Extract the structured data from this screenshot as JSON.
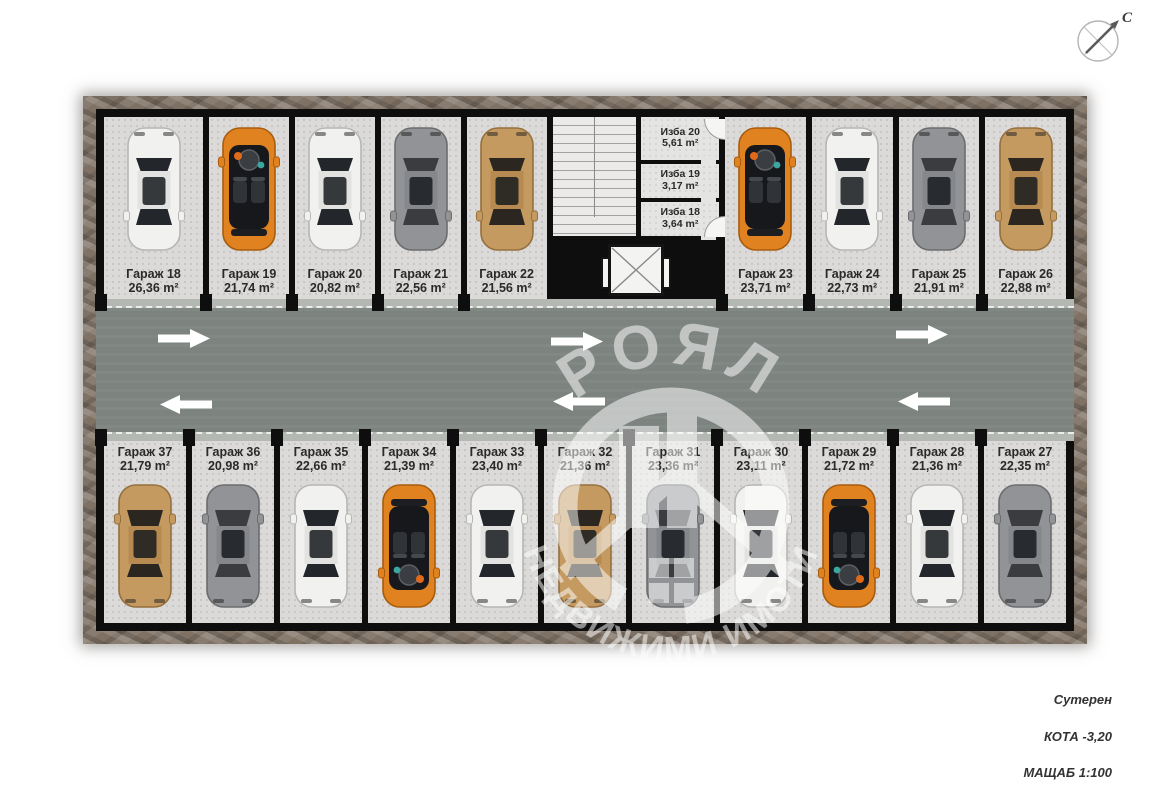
{
  "compass": {
    "north_label": "С"
  },
  "watermark": {
    "arc_top": "РОЯЛ",
    "arc_bottom": "НЕДВИЖИМИ ИМОТИ"
  },
  "legend": {
    "level_name": "Сутерен",
    "elevation": "КОТА -3,20",
    "scale": "МАЩАБ 1:100"
  },
  "colors": {
    "road": "#7d847f",
    "curb": "#b4b8b3",
    "floor": "#dbdad8",
    "wall": "#0e0e0e",
    "frame": "#7f7265",
    "car_white": "#f1f1f0",
    "car_gray": "#919396",
    "car_bronze": "#c49a60",
    "car_orange": "#e08220"
  },
  "core": {
    "izba_rooms": [
      {
        "label": "Изба 20",
        "area": "5,61 m²"
      },
      {
        "label": "Изба 19",
        "area": "3,17 m²"
      },
      {
        "label": "Изба 18",
        "area": "3,64 m²"
      }
    ]
  },
  "stalls_top_left": [
    {
      "label": "Гараж 18",
      "area": "26,36 m²",
      "car": "white"
    },
    {
      "label": "Гараж 19",
      "area": "21,74 m²",
      "car": "orange-open"
    },
    {
      "label": "Гараж 20",
      "area": "20,82 m²",
      "car": "white"
    },
    {
      "label": "Гараж 21",
      "area": "22,56 m²",
      "car": "gray"
    },
    {
      "label": "Гараж 22",
      "area": "21,56 m²",
      "car": "bronze"
    }
  ],
  "stalls_top_right": [
    {
      "label": "Гараж 23",
      "area": "23,71 m²",
      "car": "orange-open"
    },
    {
      "label": "Гараж 24",
      "area": "22,73 m²",
      "car": "white"
    },
    {
      "label": "Гараж 25",
      "area": "21,91 m²",
      "car": "gray"
    },
    {
      "label": "Гараж 26",
      "area": "22,88 m²",
      "car": "bronze"
    }
  ],
  "stalls_bottom": [
    {
      "label": "Гараж 37",
      "area": "21,79 m²",
      "car": "bronze"
    },
    {
      "label": "Гараж 36",
      "area": "20,98 m²",
      "car": "gray"
    },
    {
      "label": "Гараж 35",
      "area": "22,66 m²",
      "car": "white"
    },
    {
      "label": "Гараж 34",
      "area": "21,39 m²",
      "car": "orange-open"
    },
    {
      "label": "Гараж 33",
      "area": "23,40 m²",
      "car": "white"
    },
    {
      "label": "Гараж 32",
      "area": "21,36 m²",
      "car": "bronze"
    },
    {
      "label": "Гараж 31",
      "area": "23,36 m²",
      "car": "gray"
    },
    {
      "label": "Гараж 30",
      "area": "23,11 m²",
      "car": "white"
    },
    {
      "label": "Гараж 29",
      "area": "21,72 m²",
      "car": "orange-open"
    },
    {
      "label": "Гараж 28",
      "area": "21,36 m²",
      "car": "white"
    },
    {
      "label": "Гараж 27",
      "area": "22,35 m²",
      "car": "gray"
    }
  ]
}
